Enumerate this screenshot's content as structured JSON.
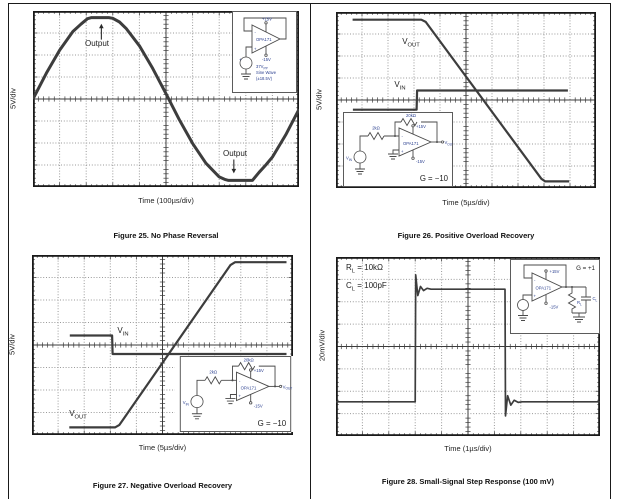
{
  "page_title": "OPA171 datasheet typical characteristic scope plots",
  "chart_data": [
    {
      "id": "figure-25",
      "type": "line",
      "title": "Figure 25. No Phase Reversal",
      "xlabel": "Time (100µs/div)",
      "ylabel": "5V/div",
      "x_divisions": 10,
      "y_divisions": 8,
      "x_range_div": [
        0,
        10
      ],
      "y_range_div": [
        -4,
        4
      ],
      "grid": "dotted with solid center cross and tick marks",
      "series": [
        {
          "name": "Output",
          "stroke_width": 3,
          "points": [
            [
              0,
              0
            ],
            [
              0.5,
              1.17
            ],
            [
              1,
              2.22
            ],
            [
              1.5,
              3.07
            ],
            [
              1.8,
              3.4
            ],
            [
              2.05,
              3.65
            ],
            [
              2.2,
              3.7
            ],
            [
              2.85,
              3.7
            ],
            [
              3.0,
              3.67
            ],
            [
              3.25,
              3.5
            ],
            [
              3.5,
              3.21
            ],
            [
              4,
              2.42
            ],
            [
              4.5,
              1.39
            ],
            [
              5,
              0.24
            ],
            [
              5.5,
              -0.94
            ],
            [
              6,
              -2.02
            ],
            [
              6.5,
              -2.92
            ],
            [
              7,
              -3.54
            ],
            [
              7.2,
              -3.65
            ],
            [
              7.35,
              -3.7
            ],
            [
              8.25,
              -3.7
            ],
            [
              8.5,
              -3.33
            ],
            [
              8.75,
              -3.0
            ],
            [
              9,
              -2.64
            ],
            [
              9.5,
              -1.63
            ],
            [
              10,
              -0.47
            ]
          ]
        }
      ],
      "annotations": [
        {
          "text": "Output",
          "x_div": 2.4,
          "y_div": 2.6,
          "arrow": {
            "x": 2.57,
            "from": 2.7,
            "to": 3.42
          }
        },
        {
          "text": "Output",
          "x_div": 7.6,
          "y_div": -2.45,
          "arrow": {
            "x": 7.55,
            "from": -2.75,
            "to": -3.38
          }
        }
      ],
      "inset": {
        "circuit": "unity-gain buffer",
        "opamp": "OPA171",
        "v_plus": "+15V",
        "v_minus": "-15V",
        "minus": "-",
        "plus": "+",
        "src_plus": "+",
        "line1_main": "37V",
        "line1_sub": "PP",
        "line2": "Sine Wave",
        "line3": "(±18.5V)"
      }
    },
    {
      "id": "figure-26",
      "type": "line",
      "title": "Figure 26. Positive Overload Recovery",
      "xlabel": "Time (5µs/div)",
      "ylabel": "5V/div",
      "x_divisions": 10,
      "y_divisions": 8,
      "x_range_div": [
        0,
        10
      ],
      "y_range_div": [
        -4,
        4
      ],
      "grid": "dotted with solid center cross and tick marks",
      "series": [
        {
          "name": "VOUT",
          "stroke_width": 2.2,
          "points": [
            [
              0.64,
              3.65
            ],
            [
              3.28,
              3.65
            ],
            [
              3.45,
              3.55
            ],
            [
              7.9,
              -3.58
            ],
            [
              8.05,
              -3.7
            ],
            [
              8.97,
              -3.7
            ]
          ]
        },
        {
          "name": "VIN",
          "stroke_width": 2.2,
          "points": [
            [
              0.65,
              -0.44
            ],
            [
              3.1,
              -0.44
            ],
            [
              3.12,
              0.43
            ],
            [
              8.92,
              0.43
            ]
          ]
        }
      ],
      "trace_labels": [
        {
          "main": "V",
          "sub": "OUT"
        },
        {
          "main": "V",
          "sub": "IN"
        }
      ],
      "inset": {
        "circuit": "inverting amplifier",
        "opamp": "OPA171",
        "v_plus": "+15V",
        "v_minus": "-15V",
        "rf": "20kΩ",
        "rin": "2kΩ",
        "src_main": "V",
        "src_sub": "IN",
        "out_main": "V",
        "out_sub": "OUT",
        "gain": "G = −10",
        "minus": "-",
        "plus": "+"
      }
    },
    {
      "id": "figure-27",
      "type": "line",
      "title": "Figure 27. Negative Overload Recovery",
      "xlabel": "Time (5µs/div)",
      "ylabel": "5V/div",
      "x_divisions": 10,
      "y_divisions": 8,
      "x_range_div": [
        0,
        10
      ],
      "y_range_div": [
        -4,
        4
      ],
      "grid": "dotted with solid center cross and tick marks",
      "series": [
        {
          "name": "VIN",
          "stroke_width": 2.2,
          "points": [
            [
              1.45,
              0.42
            ],
            [
              3.07,
              0.42
            ],
            [
              3.09,
              -0.4
            ],
            [
              9.75,
              -0.4
            ]
          ]
        },
        {
          "name": "VOUT",
          "stroke_width": 2.2,
          "points": [
            [
              1.43,
              -3.66
            ],
            [
              3.18,
              -3.66
            ],
            [
              3.35,
              -3.55
            ],
            [
              7.6,
              3.55
            ],
            [
              7.78,
              3.68
            ],
            [
              9.75,
              3.68
            ]
          ]
        }
      ],
      "trace_labels": [
        {
          "main": "V",
          "sub": "IN"
        },
        {
          "main": "V",
          "sub": "OUT"
        }
      ],
      "inset": {
        "circuit": "inverting amplifier",
        "opamp": "OPA171",
        "v_plus": "+15V",
        "v_minus": "-15V",
        "rf": "20kΩ",
        "rin": "2kΩ",
        "src_main": "V",
        "src_sub": "IN",
        "out_main": "V",
        "out_sub": "OUT",
        "gain": "G = −10",
        "minus": "-",
        "plus": "+"
      }
    },
    {
      "id": "figure-28",
      "type": "line",
      "title": "Figure 28. Small-Signal Step Response (100 mV)",
      "xlabel": "Time (1µs/div)",
      "ylabel": "20mV/div",
      "x_divisions": 10,
      "y_divisions": 8,
      "x_range_div": [
        0,
        10
      ],
      "y_range_div": [
        -4,
        4
      ],
      "grid": "dotted with solid center cross and tick marks",
      "series": [
        {
          "name": "step response",
          "stroke_width": 1.7,
          "points": [
            [
              0,
              -2.47
            ],
            [
              3.0,
              -2.47
            ],
            [
              3.02,
              3.2
            ],
            [
              3.1,
              2.28
            ],
            [
              3.2,
              2.68
            ],
            [
              3.32,
              2.5
            ],
            [
              3.45,
              2.6
            ],
            [
              3.6,
              2.56
            ],
            [
              6.4,
              2.56
            ],
            [
              6.42,
              -3.1
            ],
            [
              6.5,
              -2.2
            ],
            [
              6.62,
              -2.62
            ],
            [
              6.75,
              -2.4
            ],
            [
              6.9,
              -2.5
            ],
            [
              7.05,
              -2.47
            ],
            [
              10,
              -2.47
            ]
          ]
        }
      ],
      "annotations": [
        {
          "main": "R",
          "sub": "L",
          "rest": " = 10kΩ"
        },
        {
          "main": "C",
          "sub": "L",
          "rest": " = 100pF"
        }
      ],
      "inset": {
        "circuit": "buffer with load",
        "opamp": "OPA171",
        "v_plus": "+15V",
        "v_minus": "-15V",
        "gain": "G = +1",
        "rl_main": "R",
        "rl_sub": "L",
        "cl_main": "C",
        "cl_sub": "L",
        "minus": "-",
        "plus": "+"
      }
    }
  ]
}
